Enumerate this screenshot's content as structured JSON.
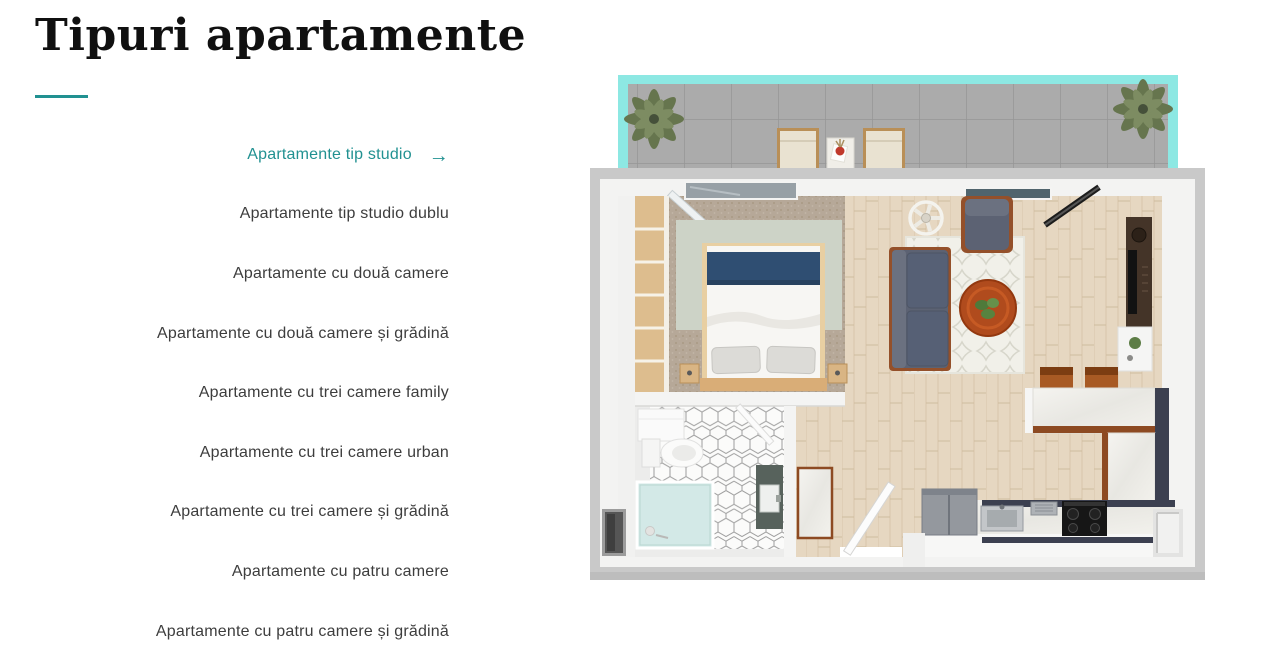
{
  "page": {
    "title": "Tipuri apartamente",
    "accent_color": "#219191"
  },
  "menu": {
    "arrow_icon": "→",
    "items": [
      {
        "label": "Apartamente tip studio",
        "active": true
      },
      {
        "label": "Apartamente tip studio dublu",
        "active": false
      },
      {
        "label": "Apartamente cu două camere",
        "active": false
      },
      {
        "label": "Apartamente cu două camere și grădină",
        "active": false
      },
      {
        "label": "Apartamente cu trei camere family",
        "active": false
      },
      {
        "label": "Apartamente cu trei camere urban",
        "active": false
      },
      {
        "label": "Apartamente cu trei camere și grădină",
        "active": false
      },
      {
        "label": "Apartamente cu patru camere",
        "active": false
      },
      {
        "label": "Apartamente cu patru camere și grădină",
        "active": false
      }
    ]
  },
  "floorplan": {
    "alt": "3D top-down render of a studio apartment: balcony with plants and chairs at top, bedroom with double bed at left, living room with sofa, armchair and round coffee table at right, kitchen at bottom right, bathroom at bottom left",
    "colors": {
      "balcony_accent": "#8de8e3",
      "outer_wall": "#c9c9c9",
      "wood_floor": "#e6d7c1",
      "sofa": "#5c6273",
      "blanket": "#2f4e72",
      "coffee_table": "#b04b1d"
    }
  }
}
